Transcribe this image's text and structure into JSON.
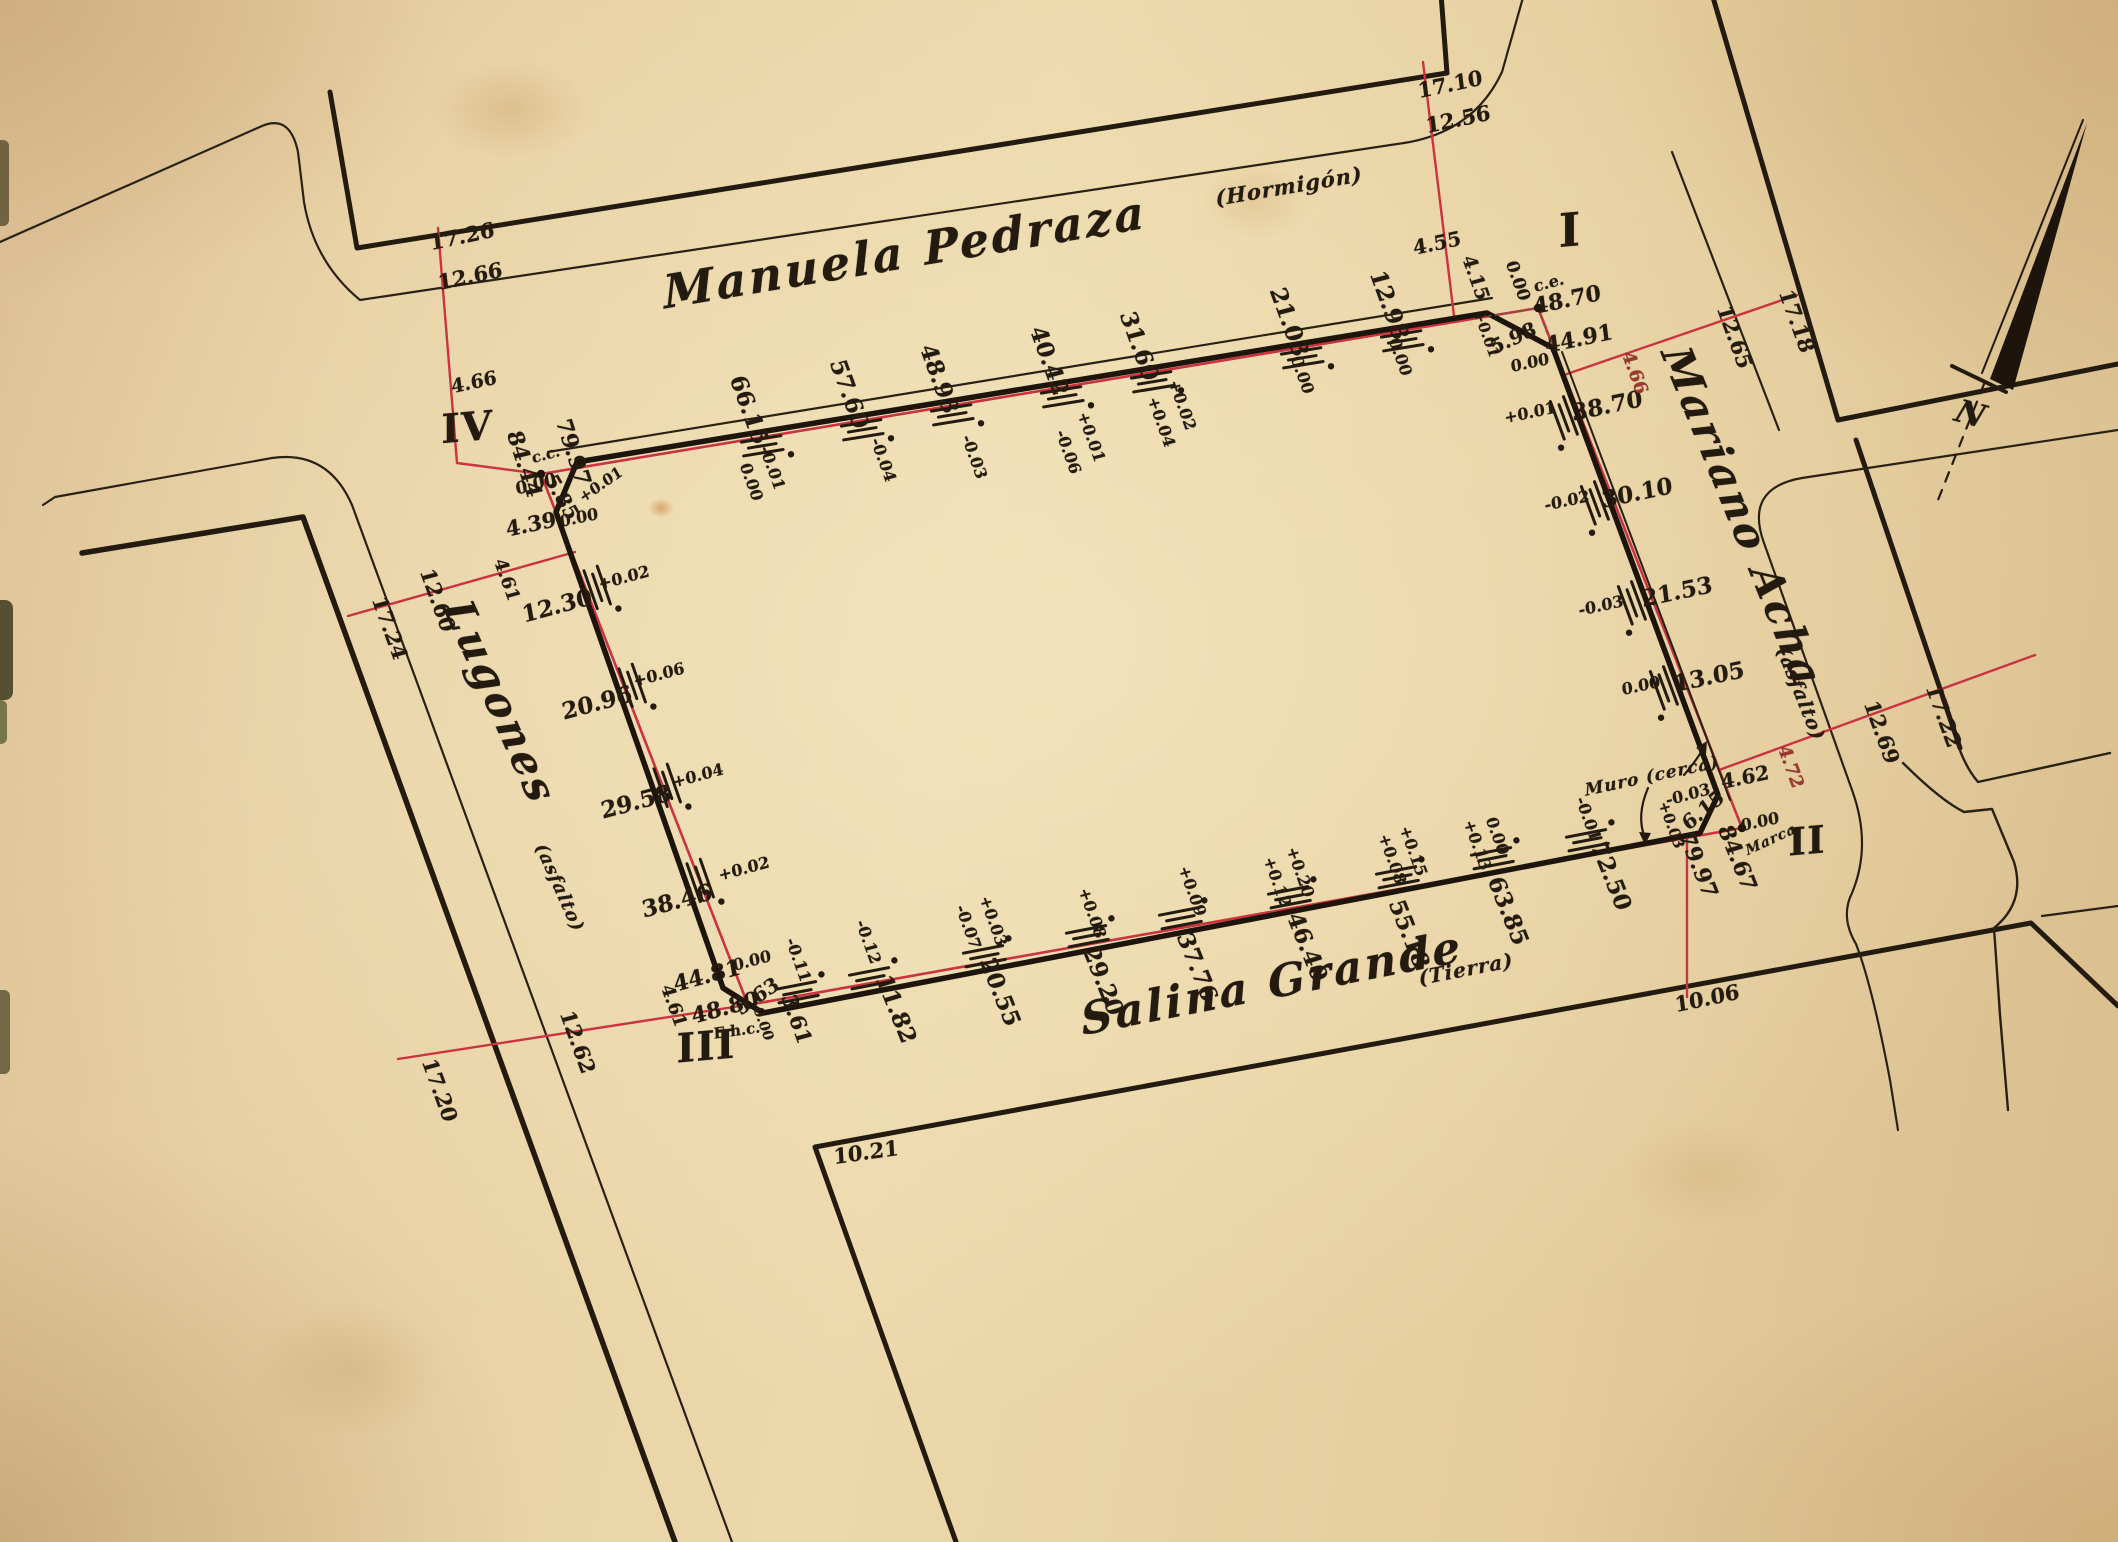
{
  "colors": {
    "ink": "#241b10",
    "red": "#cb3340",
    "red2": "#9e3632",
    "paper": "#e7d0a3"
  },
  "labels": {
    "streets": [
      {
        "n": "street-name-manuela-pedraza",
        "t": "Manuela Pedraza",
        "x": 905,
        "y": 252,
        "r": -9.5,
        "s": 46,
        "f": "script"
      },
      {
        "n": "street-surface-hormigon",
        "t": "(Hormigón)",
        "x": 1289,
        "y": 186,
        "r": -9.5,
        "s": 21,
        "f": "script2"
      },
      {
        "n": "street-name-mariano-acha",
        "t": "Mariano Acha",
        "x": 1742,
        "y": 517,
        "r": 68,
        "s": 42,
        "f": "script"
      },
      {
        "n": "street-surface-asfalto-east",
        "t": "(asfalto)",
        "x": 1800,
        "y": 694,
        "r": 68,
        "s": 19,
        "f": "script2"
      },
      {
        "n": "street-name-lugones",
        "t": "Lugones",
        "x": 500,
        "y": 702,
        "r": 66,
        "s": 42,
        "f": "script"
      },
      {
        "n": "street-surface-asfalto-west",
        "t": "(asfalto)",
        "x": 559,
        "y": 888,
        "r": 66,
        "s": 18,
        "f": "script2"
      },
      {
        "n": "street-name-salina-grande",
        "t": "Salina Grande",
        "x": 1272,
        "y": 984,
        "r": -11,
        "s": 44,
        "f": "script"
      },
      {
        "n": "street-surface-tierra",
        "t": "(Tierra)",
        "x": 1466,
        "y": 969,
        "r": -11,
        "s": 20,
        "f": "script2"
      }
    ],
    "corner_markers": [
      {
        "n": "corner-marker-1",
        "t": "I",
        "x": 1570,
        "y": 230,
        "r": -5,
        "s": 46,
        "f": "roman"
      },
      {
        "n": "corner-marker-2",
        "t": "II",
        "x": 1807,
        "y": 841,
        "r": -5,
        "s": 38,
        "f": "roman"
      },
      {
        "n": "corner-marker-3",
        "t": "III",
        "x": 706,
        "y": 1047,
        "r": -5,
        "s": 40,
        "f": "roman"
      },
      {
        "n": "corner-marker-4",
        "t": "IV",
        "x": 467,
        "y": 428,
        "r": -5,
        "s": 40,
        "f": "roman"
      }
    ],
    "north_side_measures": [
      {
        "n": "measure-north",
        "t": "66.15",
        "x": 749,
        "y": 410,
        "r": 70,
        "s": 23
      },
      {
        "n": "measure-north",
        "t": "57.60",
        "x": 849,
        "y": 394,
        "r": 70,
        "s": 23
      },
      {
        "n": "measure-north",
        "t": "48.93",
        "x": 939,
        "y": 379,
        "r": 70,
        "s": 23
      },
      {
        "n": "measure-north",
        "t": "40.42",
        "x": 1049,
        "y": 361,
        "r": 70,
        "s": 23
      },
      {
        "n": "measure-north",
        "t": "31.60",
        "x": 1139,
        "y": 346,
        "r": 70,
        "s": 23
      },
      {
        "n": "measure-north",
        "t": "21.03",
        "x": 1289,
        "y": 322,
        "r": 70,
        "s": 23
      },
      {
        "n": "measure-north",
        "t": "12.98",
        "x": 1389,
        "y": 305,
        "r": 70,
        "s": 23
      }
    ],
    "north_side_offsets": [
      {
        "n": "offset-north",
        "t": "0.00",
        "x": 751,
        "y": 482,
        "r": 70,
        "s": 16
      },
      {
        "n": "offset-north",
        "t": "-0.01",
        "x": 772,
        "y": 468,
        "r": 70,
        "s": 16
      },
      {
        "n": "offset-north",
        "t": "-0.04",
        "x": 883,
        "y": 460,
        "r": 70,
        "s": 16
      },
      {
        "n": "offset-north",
        "t": "-0.03",
        "x": 974,
        "y": 457,
        "r": 70,
        "s": 16
      },
      {
        "n": "offset-north",
        "t": "+0.01",
        "x": 1091,
        "y": 437,
        "r": 70,
        "s": 16
      },
      {
        "n": "offset-north",
        "t": "-0.06",
        "x": 1068,
        "y": 452,
        "r": 70,
        "s": 16
      },
      {
        "n": "offset-north",
        "t": "+0.02",
        "x": 1182,
        "y": 405,
        "r": 70,
        "s": 16
      },
      {
        "n": "offset-north",
        "t": "+0.04",
        "x": 1161,
        "y": 422,
        "r": 70,
        "s": 16
      },
      {
        "n": "offset-north",
        "t": "0.00",
        "x": 1302,
        "y": 375,
        "r": 70,
        "s": 16
      },
      {
        "n": "offset-north",
        "t": "0.00",
        "x": 1400,
        "y": 357,
        "r": 70,
        "s": 16
      }
    ],
    "east_side_measures": [
      {
        "n": "measure-east",
        "t": "38.70",
        "x": 1607,
        "y": 406,
        "r": -12,
        "s": 23
      },
      {
        "n": "measure-east",
        "t": "30.10",
        "x": 1637,
        "y": 493,
        "r": -12,
        "s": 23
      },
      {
        "n": "measure-east",
        "t": "21.53",
        "x": 1677,
        "y": 592,
        "r": -12,
        "s": 23
      },
      {
        "n": "measure-east",
        "t": "13.05",
        "x": 1709,
        "y": 677,
        "r": -12,
        "s": 23
      }
    ],
    "east_side_offsets": [
      {
        "n": "offset-east",
        "t": "+0.01",
        "x": 1530,
        "y": 413,
        "r": -12,
        "s": 16
      },
      {
        "n": "offset-east",
        "t": "-0.02",
        "x": 1567,
        "y": 501,
        "r": -12,
        "s": 16
      },
      {
        "n": "offset-east",
        "t": "-0.03",
        "x": 1601,
        "y": 606,
        "r": -12,
        "s": 16
      },
      {
        "n": "offset-east",
        "t": "0.00",
        "x": 1641,
        "y": 686,
        "r": -12,
        "s": 16
      }
    ],
    "west_side_measures": [
      {
        "n": "measure-west",
        "t": "12.30",
        "x": 557,
        "y": 606,
        "r": -15,
        "s": 23
      },
      {
        "n": "measure-west",
        "t": "20.96",
        "x": 597,
        "y": 703,
        "r": -15,
        "s": 23
      },
      {
        "n": "measure-west",
        "t": "29.58",
        "x": 636,
        "y": 802,
        "r": -15,
        "s": 23
      },
      {
        "n": "measure-west",
        "t": "38.46",
        "x": 677,
        "y": 901,
        "r": -15,
        "s": 23
      },
      {
        "n": "measure-west",
        "t": "44.81",
        "x": 707,
        "y": 976,
        "r": -15,
        "s": 22
      },
      {
        "n": "measure-west",
        "t": "48.80",
        "x": 725,
        "y": 1008,
        "r": -15,
        "s": 22
      }
    ],
    "west_side_offsets": [
      {
        "n": "offset-west",
        "t": "+0.02",
        "x": 624,
        "y": 578,
        "r": -15,
        "s": 16
      },
      {
        "n": "offset-west",
        "t": "+0.06",
        "x": 659,
        "y": 675,
        "r": -15,
        "s": 16
      },
      {
        "n": "offset-west",
        "t": "+0.04",
        "x": 698,
        "y": 776,
        "r": -15,
        "s": 16
      },
      {
        "n": "offset-west",
        "t": "+0.02",
        "x": 744,
        "y": 869,
        "r": -15,
        "s": 16
      }
    ],
    "south_side_measures": [
      {
        "n": "measure-south",
        "t": "3.61",
        "x": 797,
        "y": 1019,
        "r": 70,
        "s": 21
      },
      {
        "n": "measure-south",
        "t": "11.82",
        "x": 896,
        "y": 1009,
        "r": 68,
        "s": 23
      },
      {
        "n": "measure-south",
        "t": "20.55",
        "x": 1000,
        "y": 992,
        "r": 68,
        "s": 23
      },
      {
        "n": "measure-south",
        "t": "29.20",
        "x": 1103,
        "y": 981,
        "r": 68,
        "s": 23
      },
      {
        "n": "measure-south",
        "t": "37.76",
        "x": 1197,
        "y": 967,
        "r": 68,
        "s": 23
      },
      {
        "n": "measure-south",
        "t": "46.40",
        "x": 1307,
        "y": 947,
        "r": 68,
        "s": 23
      },
      {
        "n": "measure-south",
        "t": "55.18",
        "x": 1409,
        "y": 934,
        "r": 68,
        "s": 23
      },
      {
        "n": "measure-south",
        "t": "63.85",
        "x": 1508,
        "y": 911,
        "r": 68,
        "s": 23
      },
      {
        "n": "measure-south",
        "t": "72.50",
        "x": 1611,
        "y": 876,
        "r": 68,
        "s": 23
      },
      {
        "n": "measure-south",
        "t": "79.97",
        "x": 1698,
        "y": 865,
        "r": 68,
        "s": 22
      },
      {
        "n": "measure-south",
        "t": "84.67",
        "x": 1737,
        "y": 858,
        "r": 68,
        "s": 22
      }
    ],
    "south_side_offsets": [
      {
        "n": "offset-south",
        "t": "-0.11",
        "x": 798,
        "y": 960,
        "r": 70,
        "s": 16
      },
      {
        "n": "offset-south",
        "t": "-0.12",
        "x": 868,
        "y": 942,
        "r": 70,
        "s": 16
      },
      {
        "n": "offset-south",
        "t": "+0.03",
        "x": 993,
        "y": 921,
        "r": 70,
        "s": 16
      },
      {
        "n": "offset-south",
        "t": "-0.07",
        "x": 968,
        "y": 927,
        "r": 70,
        "s": 16
      },
      {
        "n": "offset-south",
        "t": "+0.08",
        "x": 1092,
        "y": 913,
        "r": 70,
        "s": 16
      },
      {
        "n": "offset-south",
        "t": "+0.09",
        "x": 1192,
        "y": 891,
        "r": 70,
        "s": 16
      },
      {
        "n": "offset-south",
        "t": "+0.20",
        "x": 1300,
        "y": 872,
        "r": 70,
        "s": 16
      },
      {
        "n": "offset-south",
        "t": "+0.12",
        "x": 1277,
        "y": 882,
        "r": 70,
        "s": 16
      },
      {
        "n": "offset-south",
        "t": "+0.15",
        "x": 1413,
        "y": 851,
        "r": 70,
        "s": 16
      },
      {
        "n": "offset-south",
        "t": "+0.08",
        "x": 1392,
        "y": 859,
        "r": 70,
        "s": 16
      },
      {
        "n": "offset-south",
        "t": "0.00",
        "x": 1497,
        "y": 836,
        "r": 70,
        "s": 16
      },
      {
        "n": "offset-south",
        "t": "+0.13",
        "x": 1477,
        "y": 845,
        "r": 70,
        "s": 16
      },
      {
        "n": "offset-south",
        "t": "-0.01",
        "x": 1588,
        "y": 819,
        "r": 70,
        "s": 16
      }
    ],
    "corner_I_annotations": [
      {
        "n": "corner1-zero",
        "t": "0.00",
        "x": 1517,
        "y": 281,
        "r": 70,
        "s": 17
      },
      {
        "n": "corner1-ce",
        "t": "c.e.",
        "x": 1549,
        "y": 283,
        "r": -15,
        "s": 16
      },
      {
        "n": "corner1-4870",
        "t": "48.70",
        "x": 1567,
        "y": 300,
        "r": -12,
        "s": 22
      },
      {
        "n": "corner1-4491",
        "t": "44.91",
        "x": 1579,
        "y": 339,
        "r": -12,
        "s": 22
      },
      {
        "n": "corner1-598",
        "t": "5.98",
        "x": 1513,
        "y": 338,
        "r": -25,
        "s": 20
      },
      {
        "n": "corner1-plus001",
        "t": "+0.01",
        "x": 1486,
        "y": 334,
        "r": 70,
        "s": 15
      },
      {
        "n": "corner1-zero2",
        "t": "0.00",
        "x": 1530,
        "y": 363,
        "r": -12,
        "s": 16
      },
      {
        "n": "corner1-415",
        "t": "4.15",
        "x": 1475,
        "y": 278,
        "r": 70,
        "s": 19
      },
      {
        "n": "corner1-455",
        "t": "4.55",
        "x": 1437,
        "y": 243,
        "r": -12,
        "s": 20
      }
    ],
    "corner_II_annotations": [
      {
        "n": "corner2-muro",
        "t": "Muro (cerca)",
        "x": 1652,
        "y": 777,
        "r": -12,
        "s": 17,
        "f": "script2"
      },
      {
        "n": "corner2-minus003",
        "t": "-0.03",
        "x": 1688,
        "y": 795,
        "r": -15,
        "s": 16
      },
      {
        "n": "corner2-plus003",
        "t": "+0.03",
        "x": 1671,
        "y": 825,
        "r": 70,
        "s": 15
      },
      {
        "n": "corner2-615",
        "t": "6.15",
        "x": 1703,
        "y": 810,
        "r": -40,
        "s": 20
      },
      {
        "n": "corner2-zero",
        "t": "0.00",
        "x": 1760,
        "y": 822,
        "r": -12,
        "s": 16
      },
      {
        "n": "corner2-marca",
        "t": "Marca",
        "x": 1771,
        "y": 840,
        "r": -25,
        "s": 14,
        "f": "script2"
      },
      {
        "n": "corner2-462",
        "t": "4.62",
        "x": 1745,
        "y": 777,
        "r": -12,
        "s": 20
      }
    ],
    "corner_III_annotations": [
      {
        "n": "corner3-zero",
        "t": "0.00",
        "x": 752,
        "y": 961,
        "r": -15,
        "s": 16
      },
      {
        "n": "corner3-563",
        "t": "5.63",
        "x": 757,
        "y": 996,
        "r": -35,
        "s": 20
      },
      {
        "n": "corner3-zero2",
        "t": "0.00",
        "x": 763,
        "y": 1024,
        "r": 70,
        "s": 14
      },
      {
        "n": "corner3-ehc",
        "t": "E.h.c.",
        "x": 737,
        "y": 1031,
        "r": -8,
        "s": 15
      }
    ],
    "corner_IV_annotations": [
      {
        "n": "corner4-8444",
        "t": "84.44",
        "x": 524,
        "y": 464,
        "r": 72,
        "s": 22
      },
      {
        "n": "corner4-cc",
        "t": "c.c.",
        "x": 546,
        "y": 455,
        "r": -15,
        "s": 15
      },
      {
        "n": "corner4-zero",
        "t": "0.00",
        "x": 536,
        "y": 485,
        "r": -15,
        "s": 17
      },
      {
        "n": "corner4-7997",
        "t": "79.97",
        "x": 573,
        "y": 452,
        "r": 72,
        "s": 22
      },
      {
        "n": "corner4-585",
        "t": "5.85",
        "x": 562,
        "y": 497,
        "r": 60,
        "s": 20
      },
      {
        "n": "corner4-plus001",
        "t": "+0.01",
        "x": 601,
        "y": 485,
        "r": -35,
        "s": 15
      },
      {
        "n": "corner4-439",
        "t": "4.39",
        "x": 531,
        "y": 524,
        "r": -12,
        "s": 21
      },
      {
        "n": "corner4-zero2",
        "t": "0.00",
        "x": 579,
        "y": 518,
        "r": -12,
        "s": 16
      }
    ],
    "street_width_marks": [
      {
        "n": "width-mark",
        "t": "17.26",
        "x": 462,
        "y": 236,
        "r": -12,
        "s": 21
      },
      {
        "n": "width-mark",
        "t": "12.66",
        "x": 470,
        "y": 276,
        "r": -12,
        "s": 21
      },
      {
        "n": "width-mark",
        "t": "4.66",
        "x": 474,
        "y": 383,
        "r": -12,
        "s": 19
      },
      {
        "n": "width-mark",
        "t": "17.10",
        "x": 1450,
        "y": 84,
        "r": -12,
        "s": 21
      },
      {
        "n": "width-mark",
        "t": "12.56",
        "x": 1458,
        "y": 119,
        "r": -12,
        "s": 21
      },
      {
        "n": "width-mark",
        "t": "17.24",
        "x": 390,
        "y": 628,
        "r": 70,
        "s": 21
      },
      {
        "n": "width-mark",
        "t": "12.60",
        "x": 438,
        "y": 600,
        "r": 70,
        "s": 21
      },
      {
        "n": "width-mark",
        "t": "4.61",
        "x": 506,
        "y": 580,
        "r": 70,
        "s": 18
      },
      {
        "n": "width-mark",
        "t": "17.20",
        "x": 440,
        "y": 1090,
        "r": 70,
        "s": 21
      },
      {
        "n": "width-mark",
        "t": "12.62",
        "x": 578,
        "y": 1042,
        "r": 70,
        "s": 21
      },
      {
        "n": "width-mark",
        "t": "4.61",
        "x": 673,
        "y": 1006,
        "r": 70,
        "s": 18
      },
      {
        "n": "width-mark",
        "t": "4.66",
        "x": 1634,
        "y": 373,
        "r": 70,
        "s": 18,
        "c": "red2"
      },
      {
        "n": "width-mark",
        "t": "12.65",
        "x": 1735,
        "y": 337,
        "r": 70,
        "s": 21
      },
      {
        "n": "width-mark",
        "t": "17.18",
        "x": 1797,
        "y": 321,
        "r": 70,
        "s": 21
      },
      {
        "n": "width-mark",
        "t": "4.72",
        "x": 1790,
        "y": 767,
        "r": 70,
        "s": 18,
        "c": "red2"
      },
      {
        "n": "width-mark",
        "t": "12.69",
        "x": 1882,
        "y": 732,
        "r": 70,
        "s": 21
      },
      {
        "n": "width-mark",
        "t": "17.22",
        "x": 1944,
        "y": 716,
        "r": 70,
        "s": 21
      },
      {
        "n": "width-mark",
        "t": "10.06",
        "x": 1707,
        "y": 998,
        "r": -12,
        "s": 21
      },
      {
        "n": "width-mark",
        "t": "10.21",
        "x": 866,
        "y": 1152,
        "r": -8,
        "s": 21
      }
    ],
    "north_arrow_label": [
      {
        "n": "north-arrow-n-label",
        "t": "N",
        "x": 1972,
        "y": 414,
        "r": 15,
        "s": 32,
        "f": "script"
      }
    ]
  },
  "ticks": [
    {
      "x": 760,
      "y": 432,
      "a": -9.3,
      "sd": 1
    },
    {
      "x": 860,
      "y": 416,
      "a": -9.3,
      "sd": 1
    },
    {
      "x": 950,
      "y": 401,
      "a": -9.3,
      "sd": 1
    },
    {
      "x": 1060,
      "y": 383,
      "a": -9.3,
      "sd": 1
    },
    {
      "x": 1150,
      "y": 368,
      "a": -9.3,
      "sd": 1
    },
    {
      "x": 1300,
      "y": 344,
      "a": -9.3,
      "sd": 1
    },
    {
      "x": 1400,
      "y": 327,
      "a": -9.3,
      "sd": 1
    },
    {
      "x": 584,
      "y": 592,
      "a": 70.7,
      "sd": -1
    },
    {
      "x": 619,
      "y": 690,
      "a": 70.7,
      "sd": -1
    },
    {
      "x": 654,
      "y": 790,
      "a": 70.7,
      "sd": -1
    },
    {
      "x": 687,
      "y": 885,
      "a": 70.7,
      "sd": -1
    },
    {
      "x": 1577,
      "y": 413,
      "a": 69.7,
      "sd": 1
    },
    {
      "x": 1608,
      "y": 498,
      "a": 69.7,
      "sd": 1
    },
    {
      "x": 1645,
      "y": 598,
      "a": 69.7,
      "sd": 1
    },
    {
      "x": 1677,
      "y": 683,
      "a": 69.7,
      "sd": 1
    },
    {
      "x": 873,
      "y": 992,
      "a": -10.9,
      "sd": -1
    },
    {
      "x": 987,
      "y": 970,
      "a": -10.9,
      "sd": -1
    },
    {
      "x": 1090,
      "y": 950,
      "a": -10.9,
      "sd": -1
    },
    {
      "x": 1183,
      "y": 932,
      "a": -10.9,
      "sd": -1
    },
    {
      "x": 1292,
      "y": 911,
      "a": -10.9,
      "sd": -1
    },
    {
      "x": 1400,
      "y": 891,
      "a": -10.9,
      "sd": -1
    },
    {
      "x": 1495,
      "y": 872,
      "a": -10.9,
      "sd": -1
    },
    {
      "x": 1590,
      "y": 854,
      "a": -10.9,
      "sd": -1
    },
    {
      "x": 800,
      "y": 1006,
      "a": -10.9,
      "sd": -1
    }
  ],
  "ref_dots": [
    {
      "n": "ref-dot-cc",
      "x": 541,
      "y": 474
    },
    {
      "n": "ref-dot-ce",
      "x": 1538,
      "y": 308
    },
    {
      "n": "ref-dot-marca",
      "x": 1742,
      "y": 828
    },
    {
      "n": "ref-dot-ehc",
      "x": 748,
      "y": 1005
    }
  ]
}
